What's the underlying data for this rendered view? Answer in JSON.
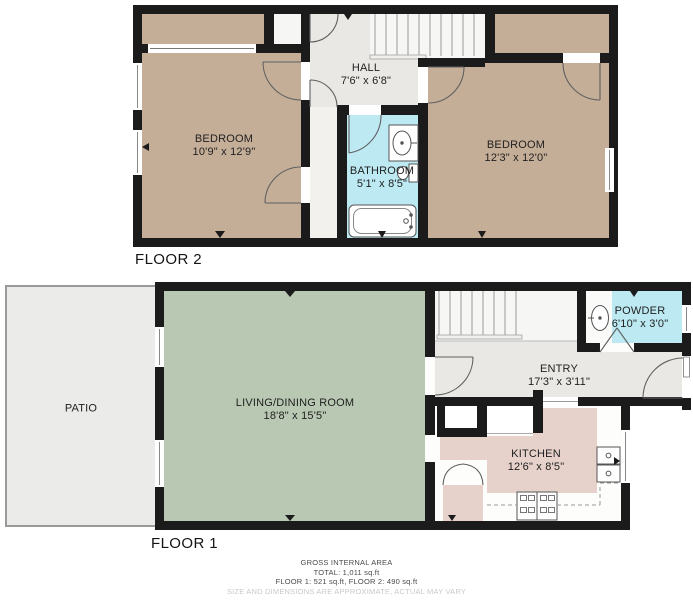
{
  "floors": [
    {
      "label": "FLOOR 2",
      "rooms": [
        {
          "name": "BEDROOM",
          "dims": "10'9\" x 12'9\""
        },
        {
          "name": "HALL",
          "dims": "7'6\" x 6'8\""
        },
        {
          "name": "BATHROOM",
          "dims": "5'1\" x 8'5\""
        },
        {
          "name": "BEDROOM",
          "dims": "12'3\" x 12'0\""
        }
      ]
    },
    {
      "label": "FLOOR 1",
      "rooms": [
        {
          "name": "PATIO",
          "dims": ""
        },
        {
          "name": "LIVING/DINING ROOM",
          "dims": "18'8\" x 15'5\""
        },
        {
          "name": "ENTRY",
          "dims": "17'3\" x 3'11\""
        },
        {
          "name": "POWDER",
          "dims": "6'10\" x 3'0\""
        },
        {
          "name": "KITCHEN",
          "dims": "12'6\" x 8'5\""
        }
      ]
    }
  ],
  "footer": {
    "title": "GROSS INTERNAL AREA",
    "total": "TOTAL: 1,011 sq.ft",
    "per_floor": "FLOOR 1: 521 sq.ft, FLOOR 2: 490 sq.ft",
    "disclaimer": "SIZE AND DIMENSIONS ARE APPROXIMATE, ACTUAL MAY VARY"
  },
  "colors": {
    "wall": "#1b1b1b",
    "room_tan": "#c5ae98",
    "living_green": "#b9c8b2",
    "kitchen_pink": "#e7d2cb",
    "bath_cyan": "#bce9f2",
    "hall_gray": "#e9e8e4",
    "patio_gray": "#ebebe9",
    "stairs_white": "#f6f6f4"
  }
}
